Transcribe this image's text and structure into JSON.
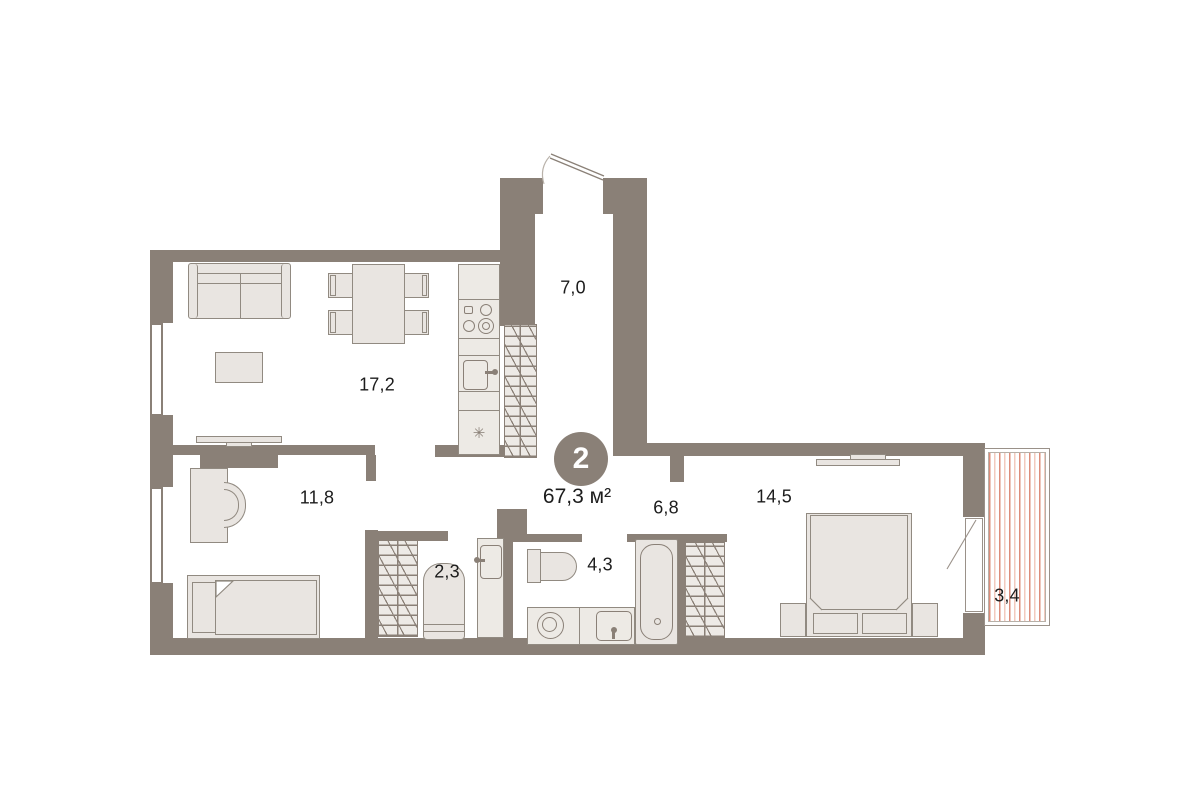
{
  "plan": {
    "badge": {
      "rooms_count": "2",
      "total_area_label": "67,3 м²"
    },
    "rooms": [
      {
        "name": "living-kitchen",
        "area": "17,2"
      },
      {
        "name": "entrance-hall",
        "area": "7,0"
      },
      {
        "name": "bedroom-small",
        "area": "11,8"
      },
      {
        "name": "storage",
        "area": "2,3"
      },
      {
        "name": "bathroom",
        "area": "4,3"
      },
      {
        "name": "corridor",
        "area": "6,8"
      },
      {
        "name": "bedroom-main",
        "area": "14,5"
      },
      {
        "name": "balcony",
        "area": "3,4"
      }
    ],
    "icons": {
      "fridge_glyph": "✳"
    },
    "colors": {
      "wall": "#8a8077",
      "furniture_fill": "#e9e5e1",
      "balcony_stripe_dark": "#dd8c7a",
      "balcony_stripe_light": "#f2cabe"
    }
  }
}
